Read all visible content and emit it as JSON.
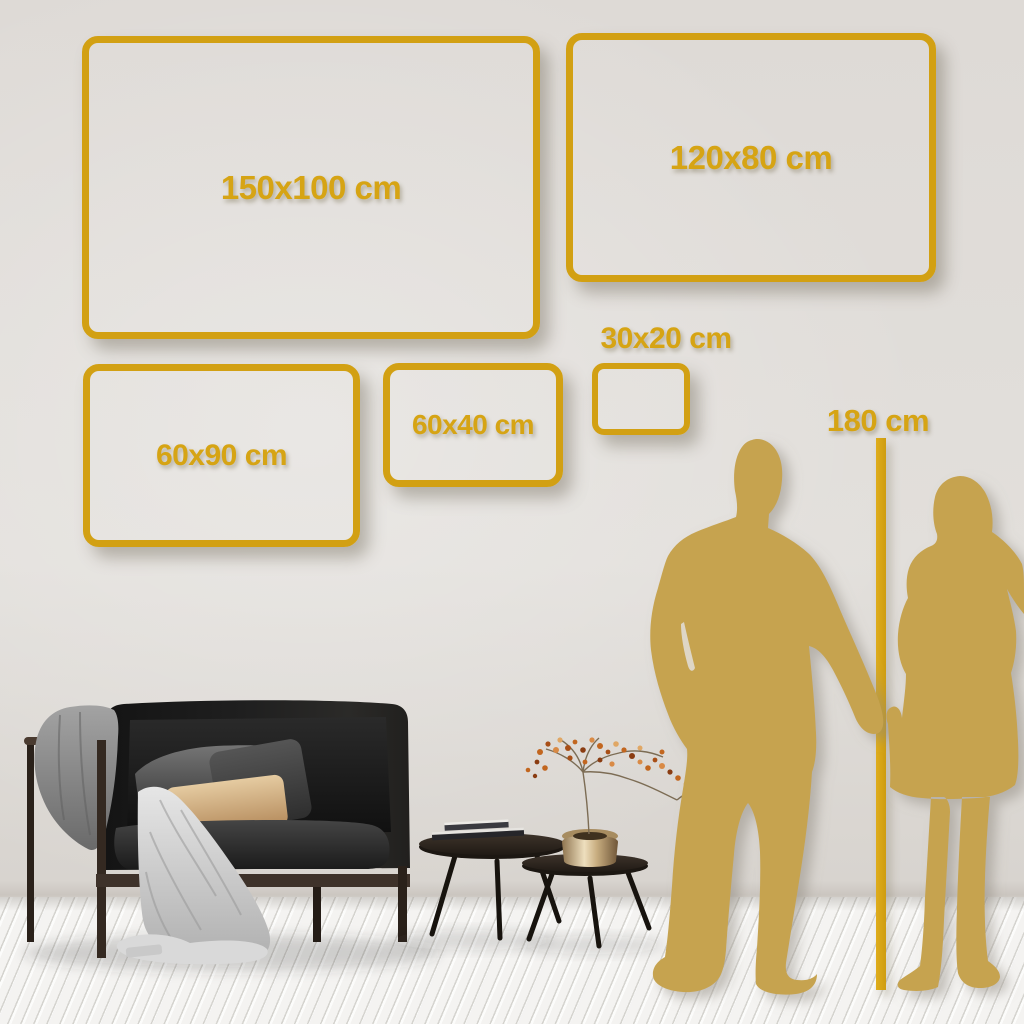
{
  "title": "Wall art size guide",
  "size_chart": {
    "type": "size-comparison",
    "unit": "cm",
    "items": [
      {
        "id": "150x100",
        "label": "150x100 cm",
        "width_cm": 150,
        "height_cm": 100
      },
      {
        "id": "120x80",
        "label": "120x80 cm",
        "width_cm": 120,
        "height_cm": 80
      },
      {
        "id": "60x90",
        "label": "60x90 cm",
        "width_cm": 60,
        "height_cm": 90
      },
      {
        "id": "60x40",
        "label": "60x40 cm",
        "width_cm": 60,
        "height_cm": 40
      },
      {
        "id": "30x20",
        "label": "30x20 cm",
        "width_cm": 30,
        "height_cm": 20
      }
    ],
    "person_reference": {
      "label": "180 cm",
      "height_cm": 180
    }
  },
  "colors": {
    "accent_gold": "#D2A013",
    "label_gold": "#D6A414",
    "silhouette_gold": "#C6A350",
    "wall": "#DFDCD8",
    "floor": "#F4F3F1"
  }
}
